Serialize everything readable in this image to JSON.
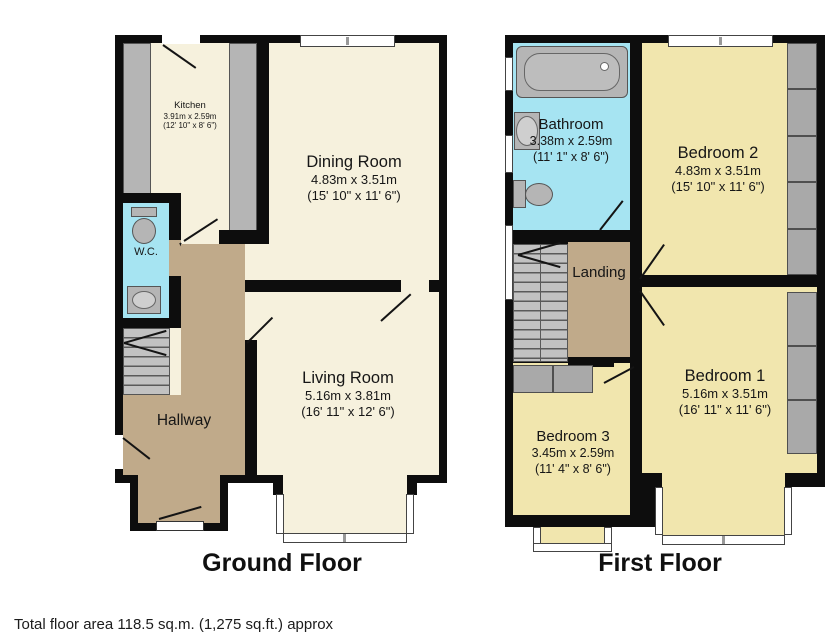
{
  "ground_floor": {
    "label": "Ground Floor",
    "rooms": {
      "kitchen": {
        "name": "Kitchen",
        "dims_m": "3.91m x 2.59m",
        "dims_ft": "(12' 10\" x 8' 6\")"
      },
      "dining": {
        "name": "Dining Room",
        "dims_m": "4.83m x 3.51m",
        "dims_ft": "(15' 10\" x 11' 6\")"
      },
      "wc": {
        "name": "W.C."
      },
      "hallway": {
        "name": "Hallway"
      },
      "living": {
        "name": "Living Room",
        "dims_m": "5.16m x 3.81m",
        "dims_ft": "(16' 11\" x 12' 6\")"
      }
    }
  },
  "first_floor": {
    "label": "First Floor",
    "rooms": {
      "bathroom": {
        "name": "Bathroom",
        "dims_m": "3.38m x 2.59m",
        "dims_ft": "(11' 1\" x 8' 6\")"
      },
      "bedroom2": {
        "name": "Bedroom 2",
        "dims_m": "4.83m x 3.51m",
        "dims_ft": "(15' 10\" x 11' 6\")"
      },
      "landing": {
        "name": "Landing"
      },
      "bedroom1": {
        "name": "Bedroom 1",
        "dims_m": "5.16m x 3.51m",
        "dims_ft": "(16' 11\" x 11' 6\")"
      },
      "bedroom3": {
        "name": "Bedroom 3",
        "dims_m": "3.45m x 2.59m",
        "dims_ft": "(11' 4\" x 8' 6\")"
      }
    }
  },
  "footer": {
    "total_area": "Total floor area 118.5 sq.m. (1,275 sq.ft.) approx"
  },
  "colors": {
    "wall": "#0d0d0d",
    "reception_cream": "#f6f1dd",
    "bedroom_yellow": "#f1e6ae",
    "hall_tan": "#c0aa8a",
    "bath_blue": "#a6e4f2",
    "fixture_gray": "#b5b5b5",
    "window_white": "#ffffff"
  }
}
